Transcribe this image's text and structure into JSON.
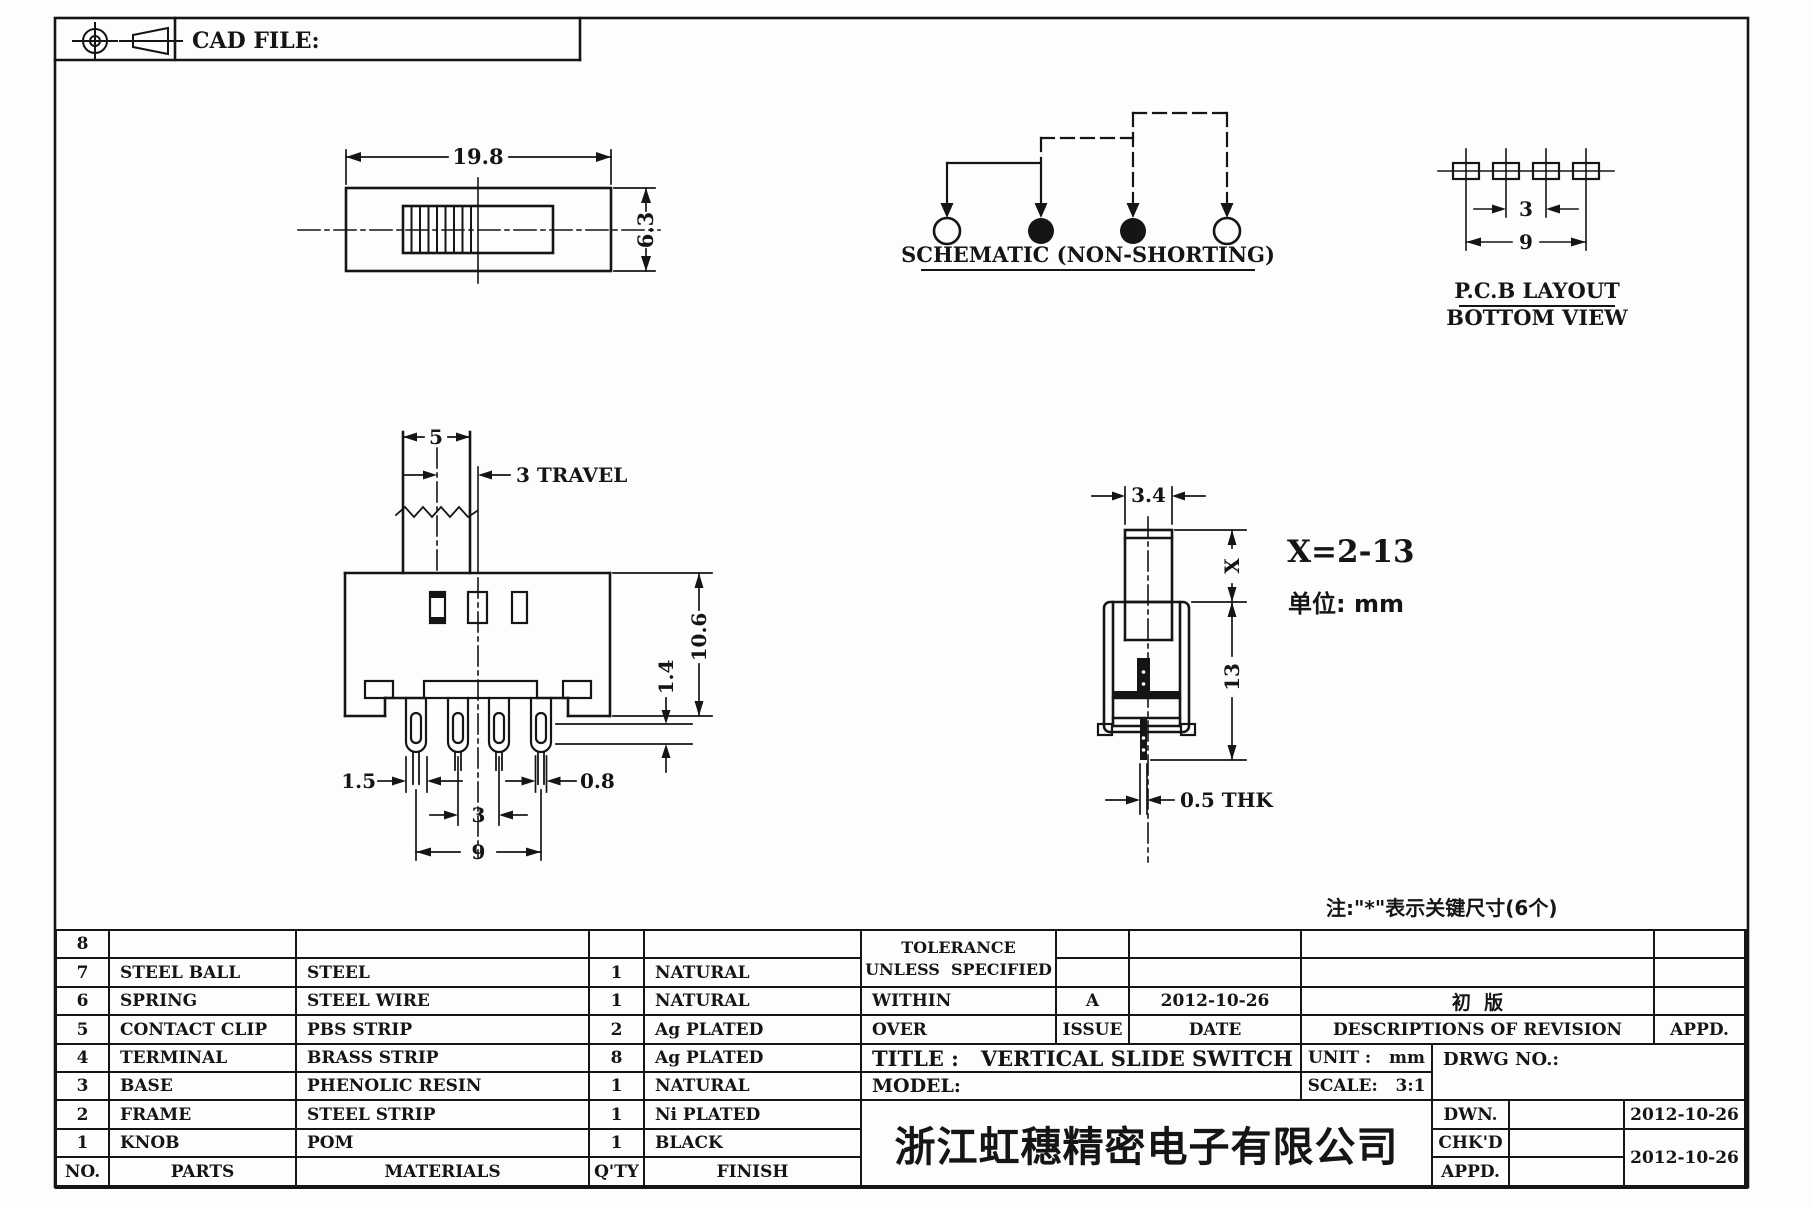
{
  "frame": {
    "cad_file_label": "CAD FILE:"
  },
  "views": {
    "top": {
      "dim_width": "19.8",
      "dim_height": "6.3"
    },
    "schematic": {
      "caption": "SCHEMATIC (NON-SHORTING)"
    },
    "pcb": {
      "dim_pitch": "3",
      "dim_span": "9",
      "caption1": "P.C.B LAYOUT",
      "caption2": "BOTTOM VIEW"
    },
    "front": {
      "dim_knob": "5",
      "dim_travel": "3 TRAVEL",
      "dim_height": "10.6",
      "dim_step": "1.4",
      "dim_pin_w": "1.5",
      "dim_pin_t": "0.8",
      "dim_pitch": "3",
      "dim_span": "9"
    },
    "side": {
      "dim_knob": "3.4",
      "dim_x": "X",
      "dim_height": "13",
      "dim_thk": "0.5 THK",
      "x_range": "X=2-13",
      "unit_note": "单位: mm"
    },
    "key_note": "注:\"*\"表示关键尺寸(6个)"
  },
  "parts_table": {
    "headers": {
      "no": "NO.",
      "parts": "PARTS",
      "materials": "MATERIALS",
      "qty": "Q'TY",
      "finish": "FINISH"
    },
    "rows": [
      {
        "no": "8",
        "part": "",
        "material": "",
        "qty": "",
        "finish": ""
      },
      {
        "no": "7",
        "part": "STEEL BALL",
        "material": "STEEL",
        "qty": "1",
        "finish": "NATURAL"
      },
      {
        "no": "6",
        "part": "SPRING",
        "material": "STEEL WIRE",
        "qty": "1",
        "finish": "NATURAL"
      },
      {
        "no": "5",
        "part": "CONTACT CLIP",
        "material": "PBS STRIP",
        "qty": "2",
        "finish": "Ag PLATED"
      },
      {
        "no": "4",
        "part": "TERMINAL",
        "material": "BRASS STRIP",
        "qty": "8",
        "finish": "Ag PLATED"
      },
      {
        "no": "3",
        "part": "BASE",
        "material": "PHENOLIC RESIN",
        "qty": "1",
        "finish": "NATURAL"
      },
      {
        "no": "2",
        "part": "FRAME",
        "material": "STEEL STRIP",
        "qty": "1",
        "finish": "Ni PLATED"
      },
      {
        "no": "1",
        "part": "KNOB",
        "material": "POM",
        "qty": "1",
        "finish": "BLACK"
      }
    ]
  },
  "title_block": {
    "tolerance1": "TOLERANCE",
    "tolerance2": "UNLESS  SPECIFIED",
    "within": "WITHIN",
    "over": "OVER",
    "issue_value": "A",
    "issue_label": "ISSUE",
    "date_value": "2012-10-26",
    "date_label": "DATE",
    "revision_text": "初  版",
    "revision_header": "DESCRIPTIONS OF REVISION",
    "appd_header": "APPD.",
    "title": "TITLE :   VERTICAL SLIDE SWITCH",
    "model": "MODEL:",
    "unit": "UNIT :   mm",
    "scale": "SCALE:   3:1",
    "drwg_no": "DRWG NO.:",
    "dwn_label": "DWN.",
    "chkd_label": "CHK'D",
    "appd_label": "APPD.",
    "dwn_date": "2012-10-26",
    "chkd_date": "2012-10-26",
    "company": "浙江虹穗精密电子有限公司"
  }
}
